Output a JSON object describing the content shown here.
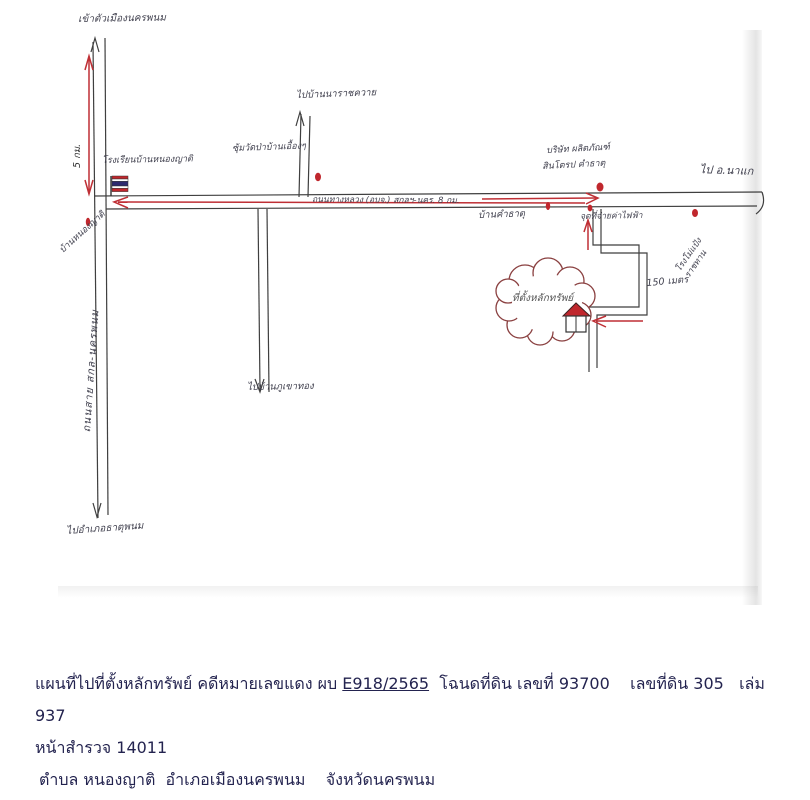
{
  "map": {
    "labels": {
      "to_city": "เข้าตัวเมืองนครพนม",
      "km5": "5 กม.",
      "left_road_name": "ถนนสาย สกล-นครพนม",
      "school": "โรงเรียนบ้านหนองญาติ",
      "ban_nong_yat": "บ้านหนองญาติ",
      "to_that_phanom": "ไปอำเภอธาตุพนม",
      "gate": "ซุ้มวัดป่าบ้านเอื้องๆ",
      "to_na_rat_khwai": "ไปบ้านนาราชควาย",
      "highway": "ถนนทางหลวง (อบจ.) สกลฯ-นคร. 8 กม.",
      "to_phu_khao_thong": "ไปบ้านภูเขาทอง",
      "ban_kham_that": "บ้านคำธาตุ",
      "company_line1": "บริษัท ผลิตภัณฑ์",
      "company_line2": "สินโตรป คำธาตุ",
      "to_na_kae": "ไป อ.นาแก",
      "electric": "จุดที่จ่ายค่าไฟฟ้า",
      "mill_line1": "โรงโม่แป้ง",
      "mill_line2": "ราชทาน",
      "distance_150m": "150 เมตร",
      "property": "ที่ตั้งหลักทรัพย์"
    },
    "colors": {
      "road": "#3f3f3f",
      "route_arrow": "#bf2f35",
      "cloud_outline": "#8a4040",
      "poi_dot": "#c0272d",
      "flag_blue": "#2d2a6e"
    }
  },
  "footer": {
    "line1_prefix": "แผนที่ไปที่ตั้งหลักทรัพย์ คดีหมายเลขแดง ผบ ",
    "case_number": "E918/2565",
    "line1_suffix": "  โฉนดที่ดิน เลขที่ 93700    เลขที่ดิน 305   เล่ม 937",
    "line2": "หน้าสำรวจ 14011",
    "line3": "ตำบล หนองญาติ  อำเภอเมืองนครพนม    จังหวัดนครพนม"
  }
}
